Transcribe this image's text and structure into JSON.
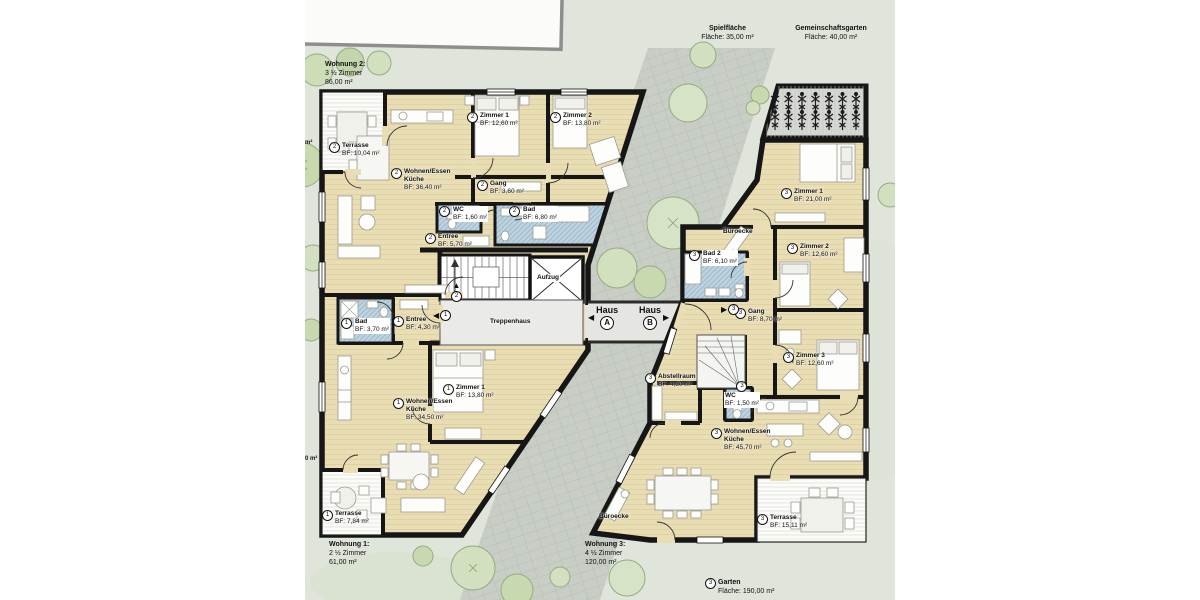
{
  "site_labels": {
    "spielflaeche": {
      "name": "Spielfläche",
      "detail": "Fläche: 35,00 m²"
    },
    "gemeinschaftsgarten": {
      "name": "Gemeinschaftsgarten",
      "detail": "Fläche: 40,00 m²"
    },
    "garten": {
      "num": "3",
      "name": "Garten",
      "detail": "Fläche: 190,00 m²"
    }
  },
  "apartments": [
    {
      "num": "1",
      "title": "Wohnung 1:",
      "rooms": "2 ½ Zimmer",
      "size": "61,00 m²"
    },
    {
      "num": "2",
      "title": "Wohnung 2:",
      "rooms": "3 ½ Zimmer",
      "size": "86,00 m²"
    },
    {
      "num": "3",
      "title": "Wohnung 3:",
      "rooms": "4 ½ Zimmer",
      "size": "120,00 m²"
    }
  ],
  "center": {
    "treppenhaus": "Treppenhaus",
    "aufzug": "Aufzug",
    "haus_word": "Haus",
    "haus_a_letter": "A",
    "haus_b_letter": "B",
    "arrow_left": "◀",
    "arrow_right": "▶",
    "arrow_up": "▲"
  },
  "room_labels": [
    {
      "num": "2",
      "name": [
        "Terrasse"
      ],
      "area": "BF: 10,04 m²",
      "x": 24,
      "y": 142
    },
    {
      "num": "2",
      "name": [
        "Wohnen/Essen",
        "Küche"
      ],
      "area": "BF: 36,40 m²",
      "x": 86,
      "y": 168
    },
    {
      "num": "2",
      "name": [
        "Zimmer 1"
      ],
      "area": "BF: 12,60 m²",
      "x": 162,
      "y": 112
    },
    {
      "num": "2",
      "name": [
        "Zimmer 2"
      ],
      "area": "BF: 13,80 m²",
      "x": 245,
      "y": 112
    },
    {
      "num": "2",
      "name": [
        "Gang"
      ],
      "area": "BF: 3,60 m²",
      "x": 172,
      "y": 180
    },
    {
      "num": "2",
      "name": [
        "WC"
      ],
      "area": "BF: 1,60 m²",
      "x": 134,
      "y": 206,
      "bg": true
    },
    {
      "num": "2",
      "name": [
        "Bad"
      ],
      "area": "BF: 6,80 m²",
      "x": 204,
      "y": 206,
      "bg": true
    },
    {
      "num": "2",
      "name": [
        "Entree"
      ],
      "area": "BF: 5,70 m²",
      "x": 120,
      "y": 233
    },
    {
      "num": "1",
      "name": [
        "Bad"
      ],
      "area": "BF: 3,70 m²",
      "x": 36,
      "y": 318,
      "bg": true
    },
    {
      "num": "1",
      "name": [
        "Entree"
      ],
      "area": "BF: 4,30 m²",
      "x": 88,
      "y": 316
    },
    {
      "num": "1",
      "name": [
        "Zimmer 1"
      ],
      "area": "BF: 13,80 m²",
      "x": 138,
      "y": 384
    },
    {
      "num": "1",
      "name": [
        "Wohnen/Essen",
        "Küche"
      ],
      "area": "BF: 34,50 m²",
      "x": 88,
      "y": 398
    },
    {
      "num": "1",
      "name": [
        "Terrasse"
      ],
      "area": "BF: 7,84 m²",
      "x": 17,
      "y": 510
    },
    {
      "num": "3",
      "name": [
        "Zimmer 1"
      ],
      "area": "BF: 21,00 m²",
      "x": 476,
      "y": 188
    },
    {
      "name": [
        "Büroecke"
      ],
      "x": 418,
      "y": 228
    },
    {
      "num": "3",
      "name": [
        "Bad 2"
      ],
      "area": "BF: 6,10 m²",
      "x": 384,
      "y": 250,
      "bg": true
    },
    {
      "num": "3",
      "name": [
        "Zimmer 2"
      ],
      "area": "BF: 12,60 m²",
      "x": 482,
      "y": 243
    },
    {
      "num": "3",
      "name": [
        "Gang"
      ],
      "area": "BF: 8,70 m²",
      "x": 430,
      "y": 308
    },
    {
      "num": "3",
      "name": [
        "Zimmer 3"
      ],
      "area": "BF: 12,60 m²",
      "x": 478,
      "y": 352
    },
    {
      "num": "3",
      "name": [
        "Abstellraum"
      ],
      "area": "BF: 4,30 m²",
      "x": 340,
      "y": 373
    },
    {
      "num": "3",
      "name": [
        "WC"
      ],
      "area": "BF: 1,50 m²",
      "x": 419,
      "y": 381,
      "col": true,
      "bg": true
    },
    {
      "num": "3",
      "name": [
        "Wohnen/Essen",
        "Küche"
      ],
      "area": "BF: 45,70 m²",
      "x": 406,
      "y": 428
    },
    {
      "name": [
        "Büroecke"
      ],
      "x": 294,
      "y": 513
    },
    {
      "num": "3",
      "name": [
        "Terrasse"
      ],
      "area": "BF: 15,11 m²",
      "x": 452,
      "y": 514
    },
    {
      "name": [
        "Treppenhaus"
      ],
      "x": 185,
      "y": 318
    },
    {
      "name": [
        "Aufzug"
      ],
      "x": 231,
      "y": 274,
      "bg": true
    }
  ],
  "nav_markers": [
    {
      "num": "2",
      "arrow": "▲",
      "dir": "col",
      "x": 146,
      "y": 282
    },
    {
      "num": "1",
      "arrow": "◀",
      "dir": "row",
      "x": 128,
      "y": 310
    },
    {
      "num": "3",
      "arrow": "▶",
      "dir": "row",
      "x": 416,
      "y": 304
    }
  ],
  "edge_fragments": [
    {
      "text": "m²",
      "x": 0,
      "y": 140
    },
    {
      "text": "0 m²",
      "x": 0,
      "y": 456
    }
  ]
}
